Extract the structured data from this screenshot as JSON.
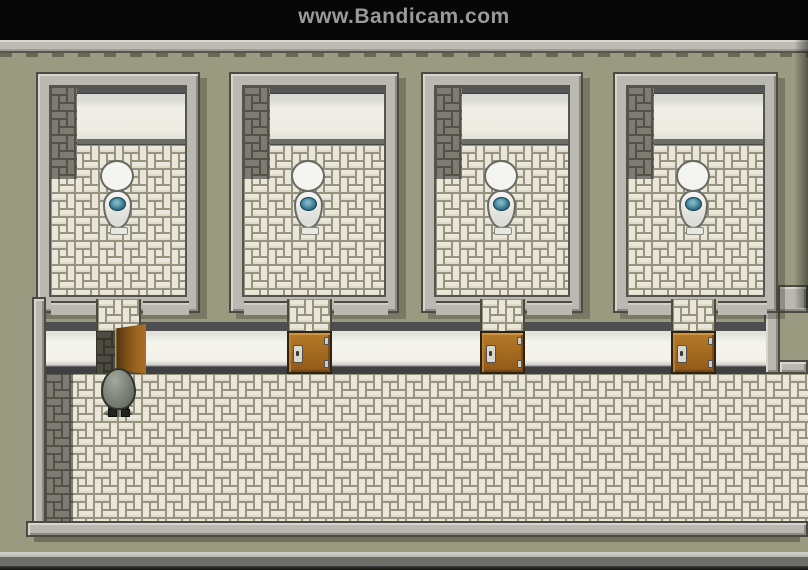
{
  "watermark": {
    "text": "www.Bandicam.com",
    "bar_color": "#070707",
    "text_color": "#9a9a9a"
  },
  "scene": {
    "description": "Top-down RPG bathroom hallway with four toilet stalls",
    "stall_count": 4,
    "stalls": [
      {
        "id": 1,
        "toilet": true,
        "door": "open"
      },
      {
        "id": 2,
        "toilet": true,
        "door": "closed"
      },
      {
        "id": 3,
        "toilet": true,
        "door": "closed"
      },
      {
        "id": 4,
        "toilet": true,
        "door": "closed"
      }
    ],
    "player": {
      "present": true,
      "position": "outside-stall-1",
      "facing": "up"
    },
    "palette": {
      "outer_wall": "#9a9a81",
      "wall_top": "#b9b9b1",
      "stall_back_wall": "#eeeee6",
      "stall_shadow_stripe": "#565659",
      "floor_tile_light": "#eae7da",
      "floor_tile_dark": "#7d7c72",
      "grout": "#96937f",
      "front_wall": "#f3f3ec",
      "door_brown": "#a86c20",
      "toilet_water": "#3e7d95"
    }
  }
}
